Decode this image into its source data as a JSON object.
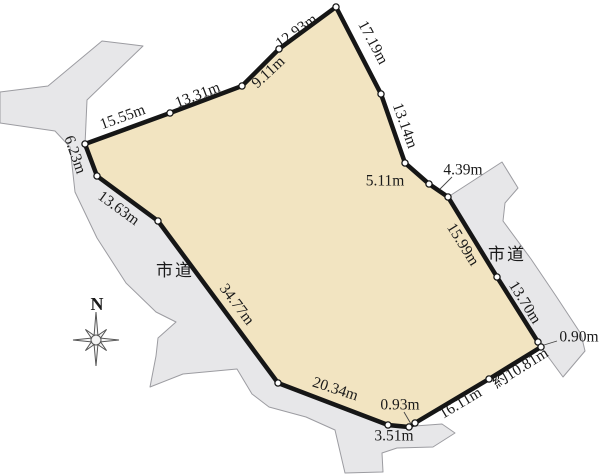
{
  "colors": {
    "background": "#ffffff",
    "plot_fill": "#f2e4c1",
    "plot_stroke": "#161616",
    "road_fill": "#e7e7e9",
    "road_stroke": "#9c9ca1",
    "text": "#1a1a1a",
    "vertex_dot_fill": "#ffffff",
    "leader_line": "#444444"
  },
  "plot": {
    "vertices": [
      [
        336,
        7
      ],
      [
        381,
        94
      ],
      [
        405,
        163
      ],
      [
        429,
        184
      ],
      [
        448,
        197
      ],
      [
        497,
        277
      ],
      [
        538,
        342
      ],
      [
        541,
        347
      ],
      [
        489,
        379
      ],
      [
        415,
        423
      ],
      [
        409,
        427
      ],
      [
        388,
        425
      ],
      [
        278,
        383
      ],
      [
        158,
        221
      ],
      [
        97,
        176
      ],
      [
        85,
        144
      ],
      [
        170,
        113
      ],
      [
        242,
        86
      ],
      [
        279,
        49
      ]
    ],
    "edge_measurements_clockwise_from_apex": [
      "17.19m",
      "13.14m",
      "5.11m",
      "4.39m",
      "15.99m",
      "13.70m",
      "0.90m",
      "約10.81m",
      "16.11m",
      "0.93m",
      "3.51m",
      "20.34m",
      "34.77m",
      "13.63m",
      "6.23m",
      "15.55m",
      "13.31m",
      "9.11m",
      "12.93m"
    ]
  },
  "labels": {
    "measurements": [
      {
        "text": "12.93m",
        "x": 297,
        "y": 32,
        "rot": -36
      },
      {
        "text": "17.19m",
        "x": 372,
        "y": 43,
        "rot": 62
      },
      {
        "text": "9.11m",
        "x": 269,
        "y": 73,
        "rot": -43
      },
      {
        "text": "13.31m",
        "x": 198,
        "y": 96,
        "rot": -21
      },
      {
        "text": "15.55m",
        "x": 123,
        "y": 118,
        "rot": -20
      },
      {
        "text": "6.23m",
        "x": 74,
        "y": 155,
        "rot": 71
      },
      {
        "text": "13.63m",
        "x": 118,
        "y": 209,
        "rot": 36
      },
      {
        "text": "13.14m",
        "x": 404,
        "y": 126,
        "rot": 70
      },
      {
        "text": "5.11m",
        "x": 385,
        "y": 182,
        "rot": 0
      },
      {
        "text": "4.39m",
        "x": 463,
        "y": 171,
        "rot": 0
      },
      {
        "text": "15.99m",
        "x": 462,
        "y": 245,
        "rot": 58
      },
      {
        "text": "13.70m",
        "x": 524,
        "y": 303,
        "rot": 58
      },
      {
        "text": "0.90m",
        "x": 579,
        "y": 338,
        "rot": 0
      },
      {
        "text": "約10.81m",
        "x": 521,
        "y": 369,
        "rot": -32
      },
      {
        "text": "16.11m",
        "x": 461,
        "y": 404,
        "rot": -31
      },
      {
        "text": "0.93m",
        "x": 400,
        "y": 406,
        "rot": 0
      },
      {
        "text": "3.51m",
        "x": 394,
        "y": 437,
        "rot": 0
      },
      {
        "text": "20.34m",
        "x": 335,
        "y": 390,
        "rot": 18
      },
      {
        "text": "34.77m",
        "x": 236,
        "y": 305,
        "rot": 53
      }
    ],
    "roads": [
      {
        "text": "市道",
        "x": 175,
        "y": 272
      },
      {
        "text": "市道",
        "x": 507,
        "y": 256
      }
    ]
  },
  "roads": [
    {
      "name": "west-city-road",
      "points": [
        [
          143,
          46
        ],
        [
          102,
          41
        ],
        [
          48,
          86
        ],
        [
          0,
          92
        ],
        [
          0,
          123
        ],
        [
          55,
          131
        ],
        [
          70,
          147
        ],
        [
          75,
          192
        ],
        [
          97,
          238
        ],
        [
          126,
          283
        ],
        [
          156,
          312
        ],
        [
          176,
          322
        ],
        [
          158,
          338
        ],
        [
          156,
          356
        ],
        [
          150,
          387
        ],
        [
          183,
          374
        ],
        [
          237,
          369
        ],
        [
          252,
          394
        ],
        [
          269,
          407
        ],
        [
          306,
          417
        ],
        [
          335,
          430
        ],
        [
          345,
          473
        ],
        [
          383,
          472
        ],
        [
          382,
          453
        ],
        [
          397,
          448
        ],
        [
          433,
          447
        ],
        [
          455,
          433
        ],
        [
          442,
          424
        ],
        [
          415,
          426
        ],
        [
          409,
          428
        ],
        [
          388,
          426
        ],
        [
          278,
          384
        ],
        [
          158,
          222
        ],
        [
          97,
          177
        ],
        [
          85,
          145
        ],
        [
          87,
          100
        ]
      ]
    },
    {
      "name": "east-city-road",
      "points": [
        [
          502,
          162
        ],
        [
          518,
          188
        ],
        [
          505,
          203
        ],
        [
          503,
          221
        ],
        [
          531,
          259
        ],
        [
          556,
          296
        ],
        [
          581,
          334
        ],
        [
          585,
          351
        ],
        [
          563,
          377
        ],
        [
          541,
          347
        ],
        [
          538,
          342
        ],
        [
          497,
          277
        ],
        [
          448,
          197
        ]
      ]
    }
  ],
  "leaders": [
    {
      "x1": 452,
      "y1": 177,
      "x2": 440,
      "y2": 189
    },
    {
      "x1": 557,
      "y1": 341,
      "x2": 544,
      "y2": 345
    },
    {
      "x1": 404,
      "y1": 412,
      "x2": 411,
      "y2": 424
    }
  ],
  "compass": {
    "label": "N",
    "cx": 96,
    "cy": 340,
    "label_x": 97,
    "label_y": 306,
    "r_north": 28,
    "r_south": 26,
    "r_east": 23,
    "r_west": 23,
    "r_diagonal": 15,
    "r_inner": 5,
    "ring_r": 5
  }
}
